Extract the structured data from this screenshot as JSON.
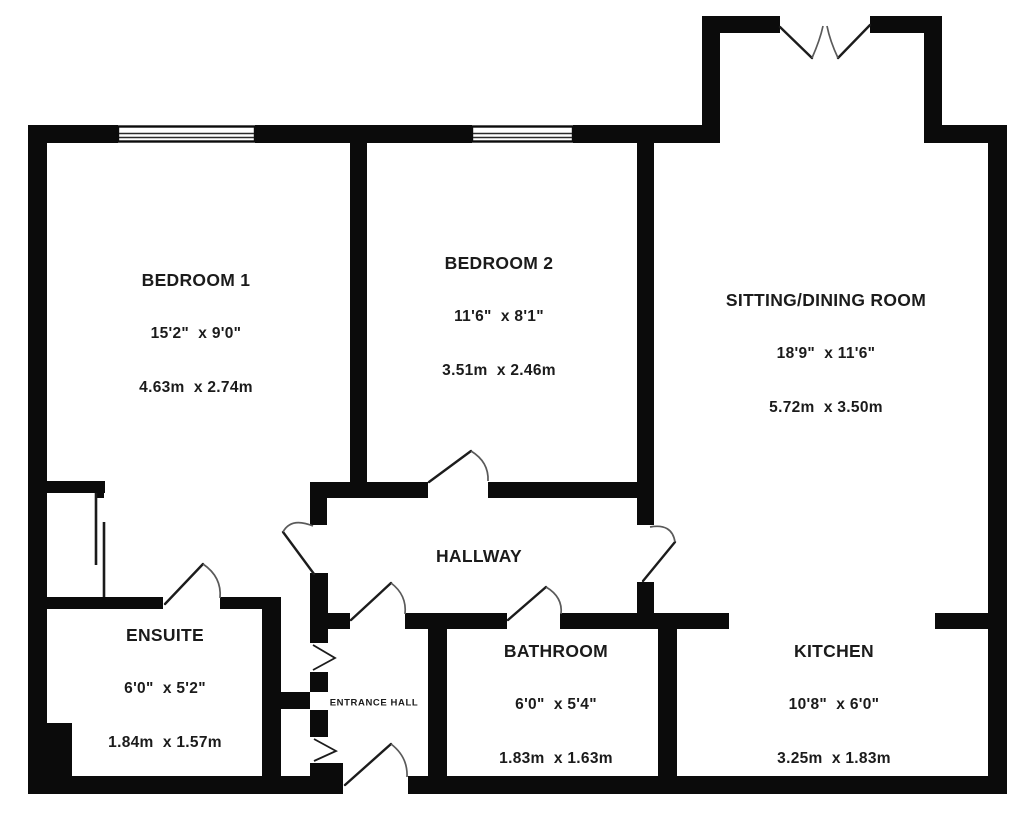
{
  "title": "Apartment floor plan",
  "colors": {
    "background": "#ffffff",
    "wall": "#0b0b0b",
    "text": "#1b1b1b"
  },
  "rooms": {
    "bedroom1": {
      "name": "BEDROOM 1",
      "imperial": "15'2\"  x 9'0\"",
      "metric": "4.63m  x 2.74m"
    },
    "bedroom2": {
      "name": "BEDROOM 2",
      "imperial": "11'6\"  x 8'1\"",
      "metric": "3.51m  x 2.46m"
    },
    "sitting_dining": {
      "name": "SITTING/DINING ROOM",
      "imperial": "18'9\"  x 11'6\"",
      "metric": "5.72m  x 3.50m"
    },
    "hallway": {
      "name": "HALLWAY"
    },
    "ensuite": {
      "name": "ENSUITE",
      "imperial": "6'0\"  x 5'2\"",
      "metric": "1.84m  x 1.57m"
    },
    "entrance_hall": {
      "name": "ENTRANCE HALL"
    },
    "bathroom": {
      "name": "BATHROOM",
      "imperial": "6'0\"  x 5'4\"",
      "metric": "1.83m  x 1.63m"
    },
    "kitchen": {
      "name": "KITCHEN",
      "imperial": "10'8\"  x 6'0\"",
      "metric": "3.25m  x 1.83m"
    }
  }
}
